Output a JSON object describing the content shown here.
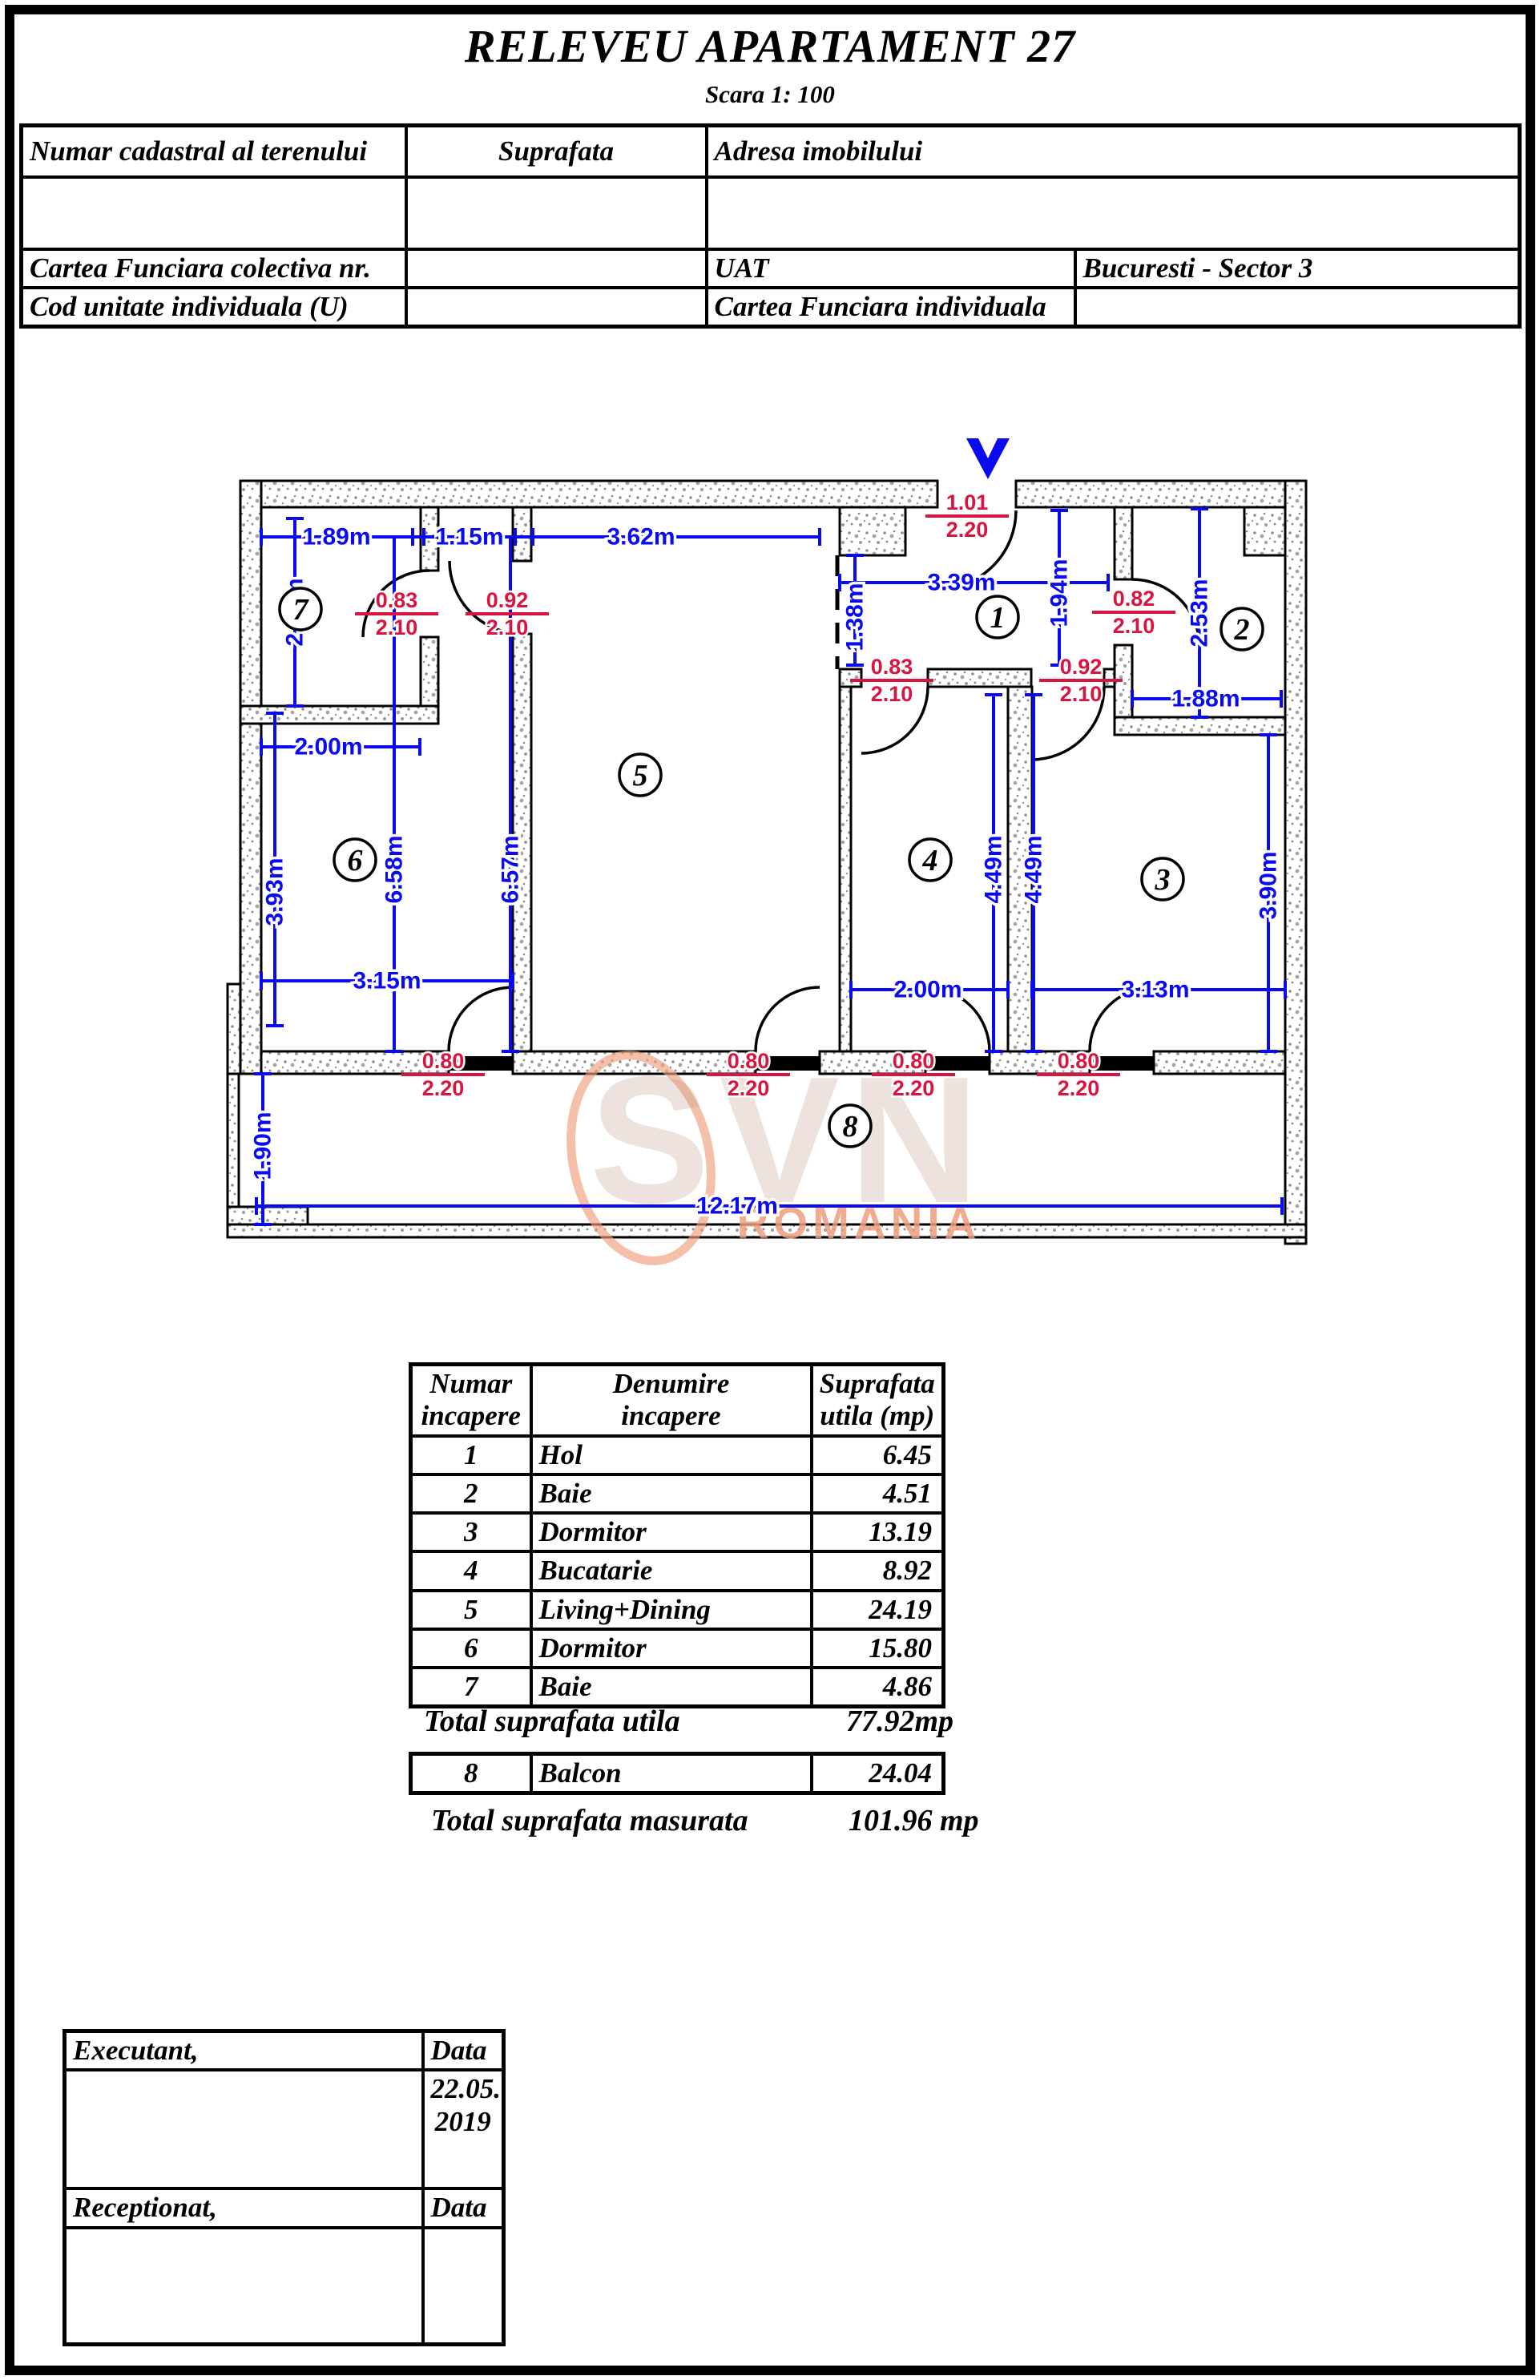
{
  "title": {
    "main": "RELEVEU APARTAMENT 27",
    "scale_label": "Scara 1: 100"
  },
  "header_table": {
    "col1": "Numar cadastral al terenului",
    "col2": "Suprafata",
    "col3": "Adresa imobilului",
    "row3_c1": "Cartea Funciara colectiva nr.",
    "row3_c3": "UAT",
    "row3_c4": "Bucuresti - Sector 3",
    "row4_c1": "Cod unitate individuala (U)",
    "row4_c3": "Cartea Funciara individuala"
  },
  "plan": {
    "dims": [
      "1.89m",
      "1.15m",
      "3.62m",
      "3.39m",
      "1.38m",
      "1.94m",
      "2.53m",
      "1.88m",
      "2.54m",
      "2.00m",
      "6.58m",
      "6.57m",
      "3.93m",
      "3.15m",
      "2.00m",
      "3.13m",
      "4.49m",
      "4.49m",
      "3.90m",
      "1.90m",
      "12.17m"
    ],
    "doors": [
      {
        "w": "1.01",
        "h": "2.20"
      },
      {
        "w": "0.83",
        "h": "2.10"
      },
      {
        "w": "0.92",
        "h": "2.10"
      },
      {
        "w": "0.82",
        "h": "2.10"
      },
      {
        "w": "0.83",
        "h": "2.10"
      },
      {
        "w": "0.92",
        "h": "2.10"
      },
      {
        "w": "0.80",
        "h": "2.20"
      },
      {
        "w": "0.80",
        "h": "2.20"
      },
      {
        "w": "0.80",
        "h": "2.20"
      },
      {
        "w": "0.80",
        "h": "2.20"
      }
    ],
    "rooms": [
      "7",
      "6",
      "5",
      "1",
      "2",
      "4",
      "3",
      "8"
    ],
    "watermark": {
      "brand": "SVN",
      "region": "ROMANIA"
    },
    "colors": {
      "dimension_blue": "#0a0af0",
      "door_red": "#d81540"
    }
  },
  "room_table": {
    "header": {
      "c1a": "Numar",
      "c1b": "incapere",
      "c2a": "Denumire",
      "c2b": "incapere",
      "c3a": "Suprafata",
      "c3b": "utila (mp)"
    },
    "rows": [
      {
        "nr": "1",
        "name": "Hol",
        "area": "6.45"
      },
      {
        "nr": "2",
        "name": "Baie",
        "area": "4.51"
      },
      {
        "nr": "3",
        "name": "Dormitor",
        "area": "13.19"
      },
      {
        "nr": "4",
        "name": "Bucatarie",
        "area": "8.92"
      },
      {
        "nr": "5",
        "name": "Living+Dining",
        "area": "24.19"
      },
      {
        "nr": "6",
        "name": "Dormitor",
        "area": "15.80"
      },
      {
        "nr": "7",
        "name": "Baie",
        "area": "4.86"
      }
    ],
    "total_utila_label": "Total suprafata utila",
    "total_utila_value": "77.92mp",
    "balcony_row": {
      "nr": "8",
      "name": "Balcon",
      "area": "24.04"
    },
    "total_masurata_label": "Total suprafata masurata",
    "total_masurata_value": "101.96 mp"
  },
  "sign_table": {
    "executant": "Executant,",
    "data_label_1": "Data",
    "date_line1": "22.05.",
    "date_line2": "2019",
    "receptionat": "Receptionat,",
    "data_label_2": "Data"
  }
}
